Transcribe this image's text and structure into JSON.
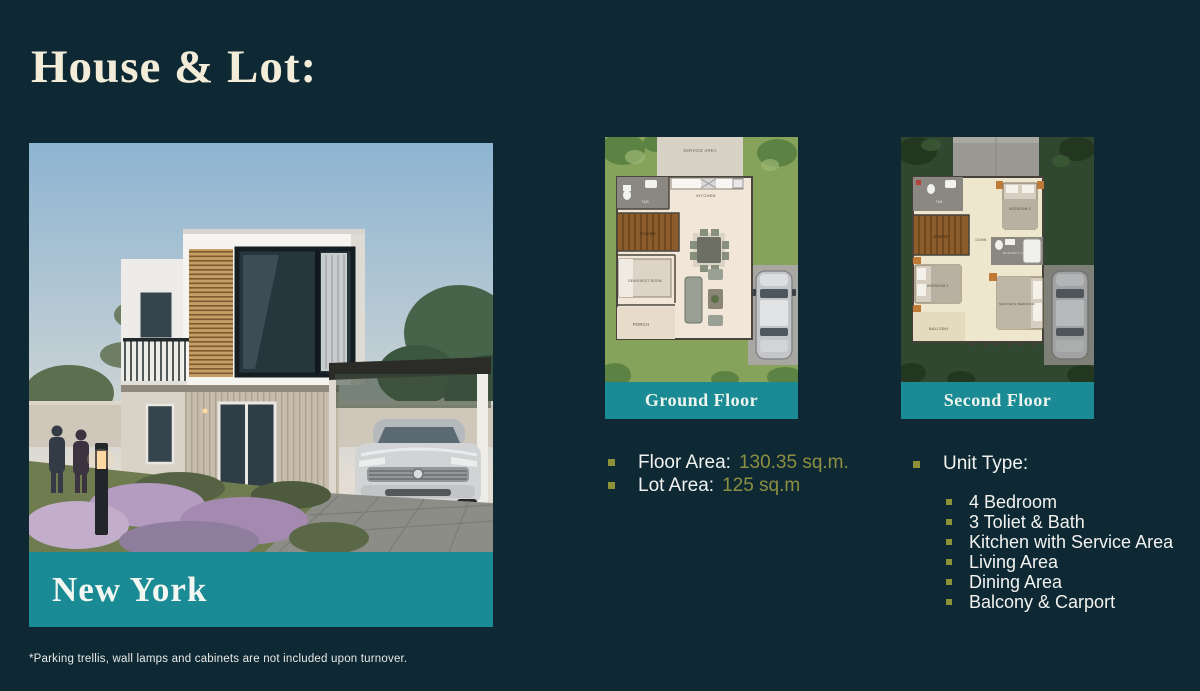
{
  "page": {
    "title": "House & Lot:",
    "footnote": "*Parking trellis, wall lamps and cabinets are not included upon turnover.",
    "background_color": "#0e2933"
  },
  "colors": {
    "teal_banner": "#1a8a94",
    "olive_accent": "#8d8f42",
    "cream_title": "#f2ecd9"
  },
  "house": {
    "name": "New York"
  },
  "floor_plans": {
    "ground": {
      "label": "Ground Floor",
      "rooms": {
        "service_area": "SERVICE AREA",
        "kitchen": "KITCHEN",
        "t_and_b": "T&B",
        "stairs": "STAIRS",
        "den_guest_room": "DEN/GUEST ROOM",
        "porch": "PORCH"
      }
    },
    "second": {
      "label": "Second Floor",
      "rooms": {
        "t_and_b": "T&B",
        "stairs": "STAIRS",
        "down": "DOWN",
        "bedroom_3": "BEDROOM 3",
        "masters_t_and_b": "MASTER'S T&B",
        "bedroom_2": "BEDROOM 2",
        "masters_bedroom": "MASTER'S BEDROOM",
        "balcony": "BALCONY"
      }
    }
  },
  "specs": {
    "floor_area": {
      "label": "Floor Area:",
      "value": "130.35 sq.m."
    },
    "lot_area": {
      "label": "Lot Area:",
      "value": "125 sq.m"
    }
  },
  "unit_type": {
    "label": "Unit Type:",
    "items": [
      "4 Bedroom",
      "3 Toliet & Bath",
      "Kitchen with Service Area",
      "Living Area",
      "Dining Area",
      "Balcony & Carport"
    ]
  }
}
